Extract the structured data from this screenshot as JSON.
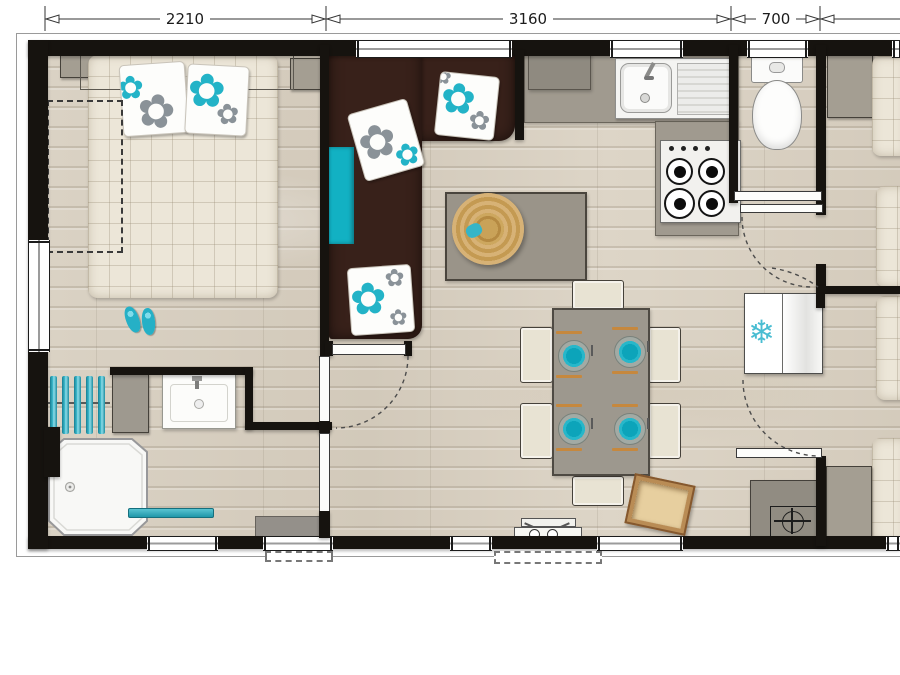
{
  "title": "mobile-home floor plan",
  "dimensions": {
    "bedroom_width_mm": "2210",
    "living_width_mm": "3160",
    "wc_width_mm": "700"
  },
  "icons": {
    "snowflake-icon": "❄",
    "flower-icon": "✿"
  },
  "colors": {
    "accent_teal": "#29b2c6",
    "sofa_brown": "#38211a",
    "wall_black": "#16130f",
    "floor_beige": "#d7cfc0",
    "counter_gray": "#a09a8f"
  }
}
